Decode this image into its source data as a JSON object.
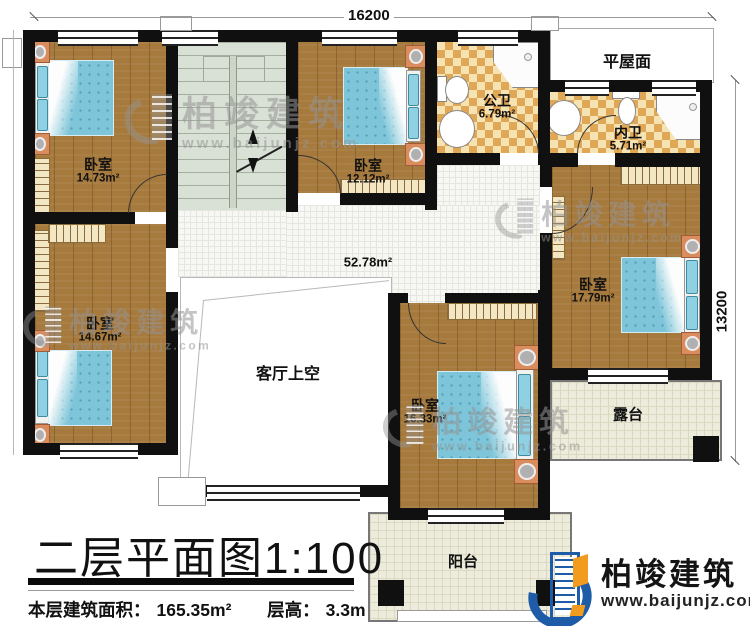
{
  "dimensions": {
    "top": "16200",
    "right": "13200"
  },
  "rooms": {
    "bedroom_top_left": {
      "label": "卧室",
      "area": "14.73m²"
    },
    "bedroom_top_center": {
      "label": "卧室",
      "area": "12.12m²"
    },
    "bedroom_mid_left": {
      "label": "卧室",
      "area": "14.67m²"
    },
    "bedroom_right": {
      "label": "卧室",
      "area": "17.79m²"
    },
    "bedroom_bottom": {
      "label": "卧室",
      "area": "16.33m²"
    },
    "public_bath": {
      "label": "公卫",
      "area": "6.79m²"
    },
    "private_bath": {
      "label": "内卫",
      "area": "5.71m²"
    },
    "hallway": {
      "area": "52.78m²"
    },
    "flat_roof": {
      "label": "平屋面"
    },
    "living_void": {
      "label": "客厅上空"
    },
    "terrace": {
      "label": "露台"
    },
    "balcony": {
      "label": "阳台"
    }
  },
  "title": {
    "main": "二层平面图",
    "scale": "1:100"
  },
  "footer": {
    "area_label": "本层建筑面积：",
    "area_value": "165.35m²",
    "height_label": "层高：",
    "height_value": "3.3m"
  },
  "watermark": {
    "brand": "柏竣建筑",
    "url": "www.baijunjz.com"
  },
  "logo": {
    "brand": "柏竣建筑",
    "url": "www.baijunjz.com"
  },
  "colors": {
    "wall": "#101010",
    "wood": "#a6793c",
    "bath_tile": "#e0a757",
    "bed": "#7ec5d9",
    "logo_blue": "#1e5ca8",
    "logo_orange": "#f29c1f"
  }
}
